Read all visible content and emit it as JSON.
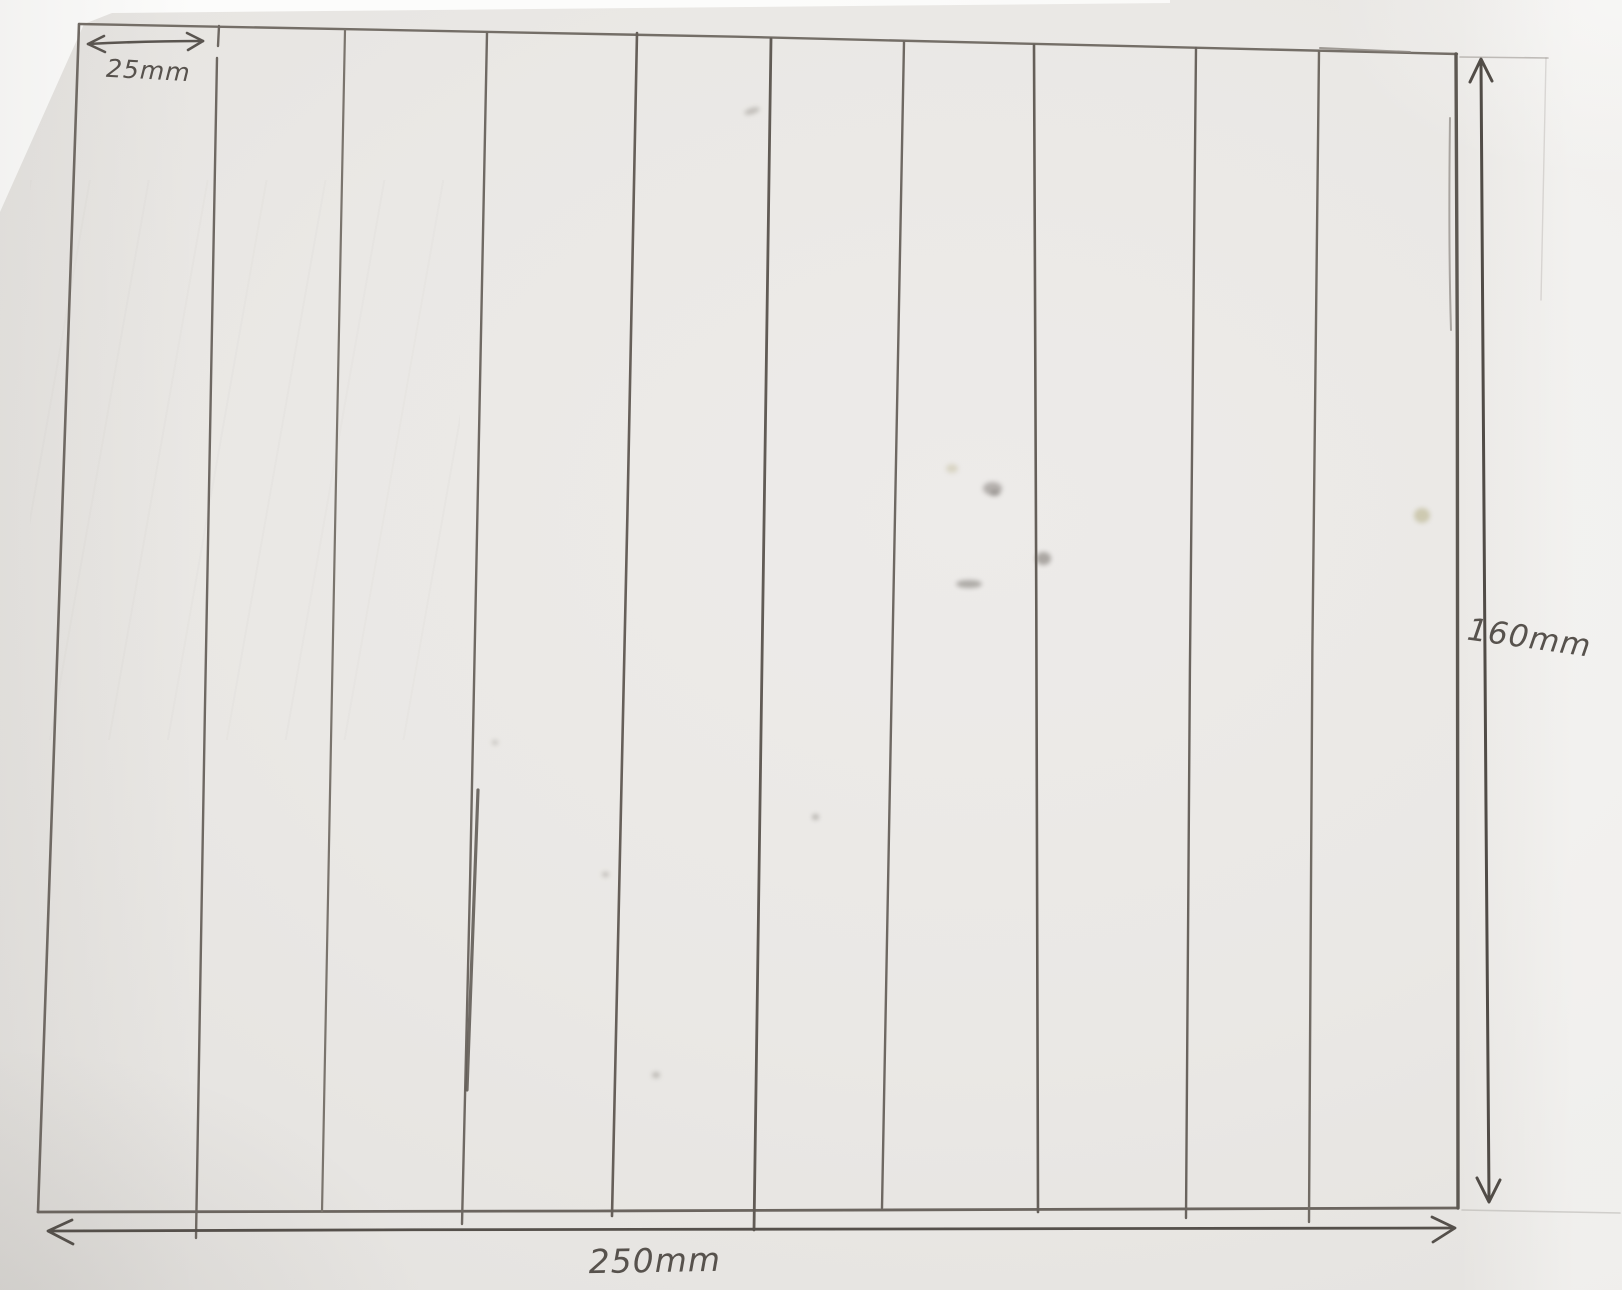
{
  "meta": {
    "description": "Photograph of a hand-drawn pencil sketch: a rectangle divided into ten equal vertical strips with dimension annotations"
  },
  "sketch": {
    "strip_count": 10,
    "divider_count": 9,
    "labels": {
      "strip_width": "25mm",
      "total_height": "160mm",
      "total_width": "250mm"
    },
    "colors": {
      "paper": "#eae8e5",
      "background_white": "#fcfcfb",
      "pencil": "#6e6862",
      "pencil_dark": "#56514c"
    }
  }
}
